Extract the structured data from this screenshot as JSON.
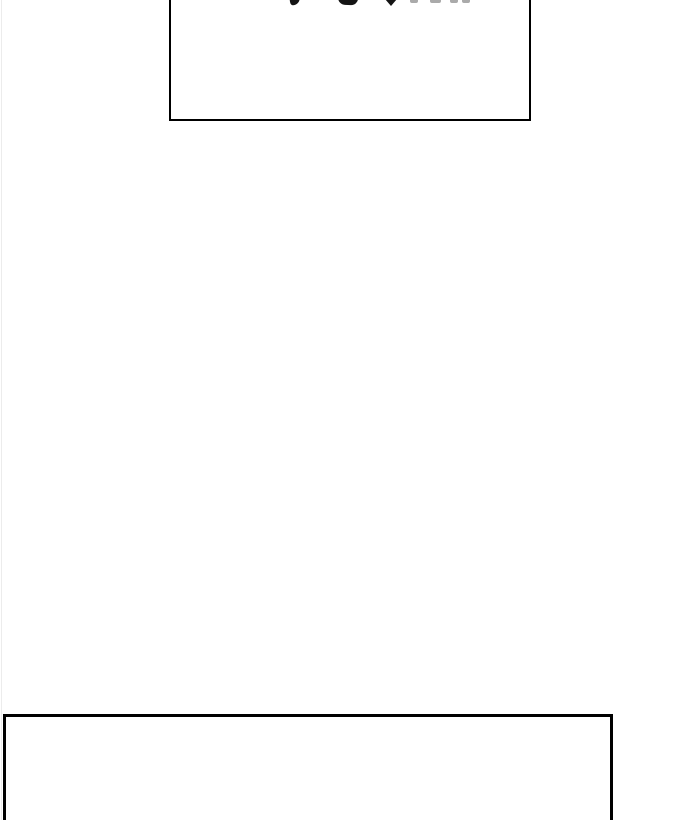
{
  "canvas": {
    "background_color": "#ffffff",
    "left_edge_line_color": "#ececec"
  },
  "top_box": {
    "label": "",
    "border_color": "#000000"
  },
  "bottom_box": {
    "label": "",
    "border_color": "#000000"
  },
  "clipped_text": {
    "dark_fragment_color": "#141414",
    "faint_fragment_color": "#aaaaaa"
  }
}
